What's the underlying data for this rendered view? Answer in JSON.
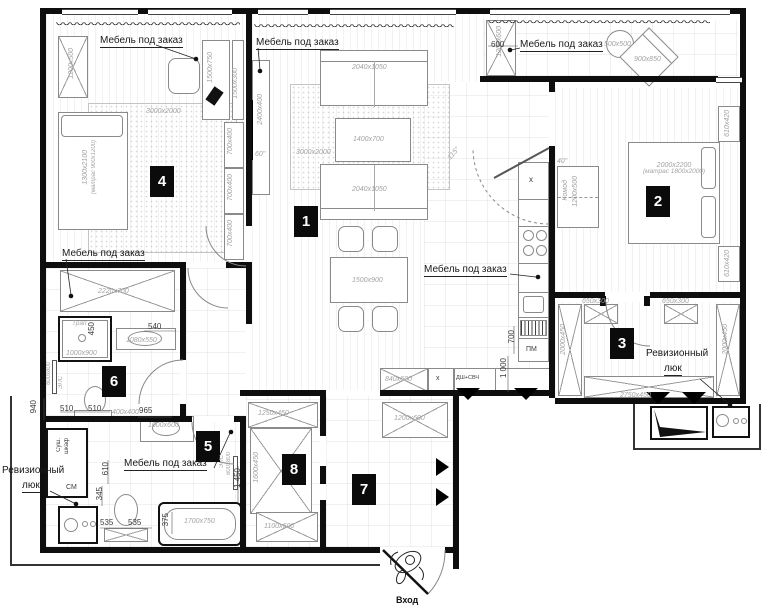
{
  "labels": {
    "custom_furniture": "Мебель под заказ",
    "inspection_hatch_line1": "Ревизионный",
    "inspection_hatch_line2": "люк",
    "entrance": "Вход"
  },
  "room_numbers": {
    "n1": "1",
    "n2": "2",
    "n3": "3",
    "n4": "4",
    "n5": "5",
    "n6": "6",
    "n7": "7",
    "n8": "8"
  },
  "room4": {
    "wardrobe": "1200x500",
    "desk": "1500x750",
    "shelf": "1500x300",
    "cabinet": "700x400",
    "rug": "3000x2000",
    "bed_size": "1300x2100",
    "bed_mattress": "(матрас 900x1200)",
    "lower_wardrobe": "2220x700"
  },
  "room1": {
    "tv_unit": "2400x400",
    "tv_size": "60\"",
    "sofa": "2040x1050",
    "coffee_table": "1400x700",
    "rug": "3000x2000",
    "dining_table": "1500x900"
  },
  "balcony": {
    "cabinet": "1200x600",
    "cabinet_depth": "600",
    "table": "500x500",
    "chair": "900x850"
  },
  "room2": {
    "bed_size": "2000x2200",
    "bed_mattress": "(матрас 1800x2000)",
    "nightstand": "610x420",
    "dresser_line1": "Комод",
    "dresser_line2": "1200x500",
    "tv_size": "40\""
  },
  "room3": {
    "upper_shelf": "650x300",
    "side_unit": "2000x450",
    "bottom_unit": "2750x450"
  },
  "kitchen": {
    "hood": "x",
    "dishwasher": "ПМ",
    "oven_microwave": "ДШ+СВЧ",
    "base_cabinet": "840x600",
    "base_x": "x",
    "dim_700": "700",
    "dim_1000": "1 000",
    "door_angle": "115°"
  },
  "room6": {
    "dim_450": "450",
    "dim_540": "540",
    "shower": "1000x900",
    "drain": "Трап",
    "sink": "1080x550",
    "dim_940": "940",
    "dim_510": "510"
  },
  "room5": {
    "corner": "400x400",
    "dim_965": "965",
    "sink": "1000x600",
    "dryer_line1": "Суш.",
    "dryer_line2": "шкаф",
    "washer": "СМ",
    "dim_610": "610",
    "dim_345": "345",
    "dim_535": "535",
    "bathtub": "1700x750",
    "dim_375": "375",
    "rail_height": "1 450"
  },
  "towel_rail": {
    "abbr": "ЭПС",
    "size": "600x800"
  },
  "hall7": {
    "wardrobe": "1200x600"
  },
  "room8": {
    "upper": "1250x450",
    "side": "1600x450",
    "lower": "1100x600"
  }
}
